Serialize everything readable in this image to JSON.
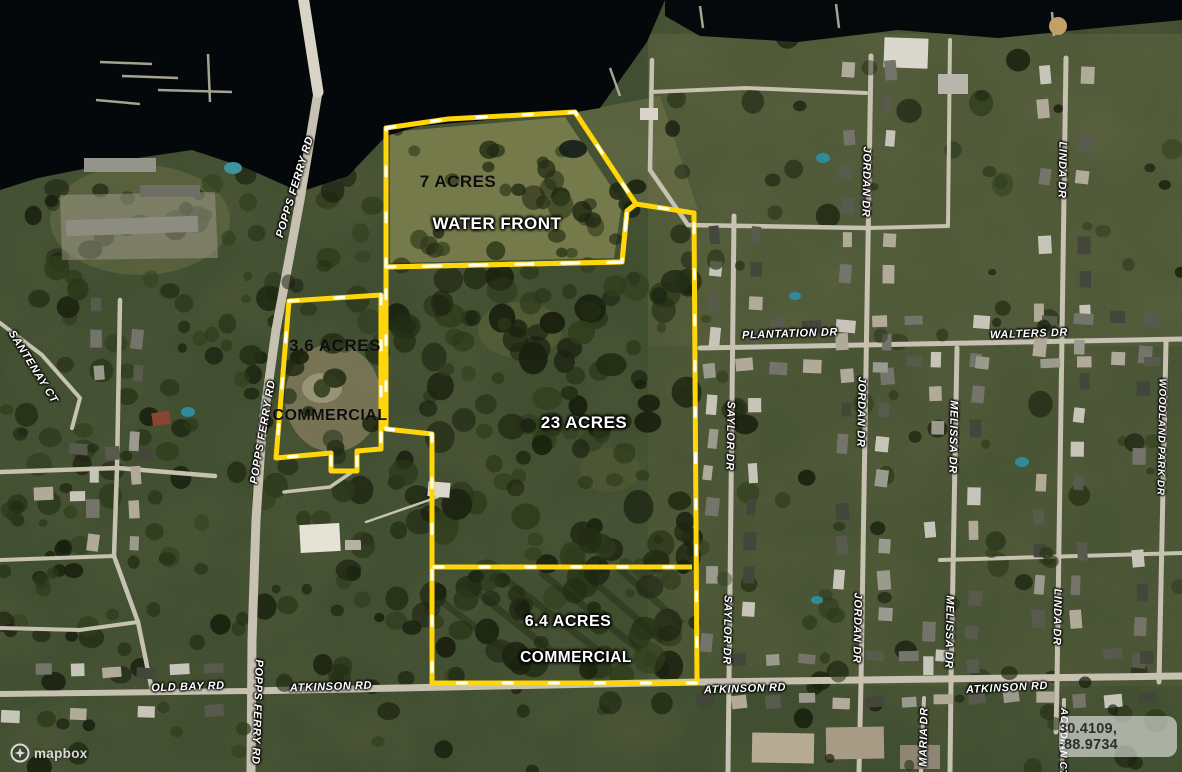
{
  "map": {
    "type": "satellite",
    "attribution": "mapbox",
    "coordinates": "30.4109, -88.9734"
  },
  "parcels": [
    {
      "acres": 7,
      "label": "7 ACRES",
      "sublabel": "WATER FRONT"
    },
    {
      "acres": 3.6,
      "label": "3.6 ACRES",
      "sublabel": "COMMERCIAL"
    },
    {
      "acres": 23,
      "label": "23 ACRES",
      "sublabel": ""
    },
    {
      "acres": 6.4,
      "label": "6.4 ACRES",
      "sublabel": "COMMERCIAL"
    }
  ],
  "road_labels": [
    {
      "text": "POPPS FERRY RD"
    },
    {
      "text": "POPPS FERRY RD"
    },
    {
      "text": "POPPS FERRY RD"
    },
    {
      "text": "PLANTATION DR"
    },
    {
      "text": "WALTERS DR"
    },
    {
      "text": "SAYLOR DR"
    },
    {
      "text": "SAYLOR DR"
    },
    {
      "text": "JORDAN DR"
    },
    {
      "text": "JORDAN DR"
    },
    {
      "text": "JORDAN DR"
    },
    {
      "text": "MELISSA DR"
    },
    {
      "text": "MELISSA DR"
    },
    {
      "text": "LINDA DR"
    },
    {
      "text": "LINDA DR"
    },
    {
      "text": "WOODLAND PARK DR"
    },
    {
      "text": "OLD BAY RD"
    },
    {
      "text": "ATKINSON RD"
    },
    {
      "text": "ATKINSON RD"
    },
    {
      "text": "ATKINSON RD"
    },
    {
      "text": "SANTENAY CT"
    },
    {
      "text": "MARIA DR"
    },
    {
      "text": "ACADIAN CT"
    }
  ],
  "colors": {
    "parcel_outline": "#FFD60A",
    "parcel_dash": "#FFFFFF",
    "water": "#05080a",
    "road": "#c6c1b0",
    "land": "#5e6340"
  }
}
